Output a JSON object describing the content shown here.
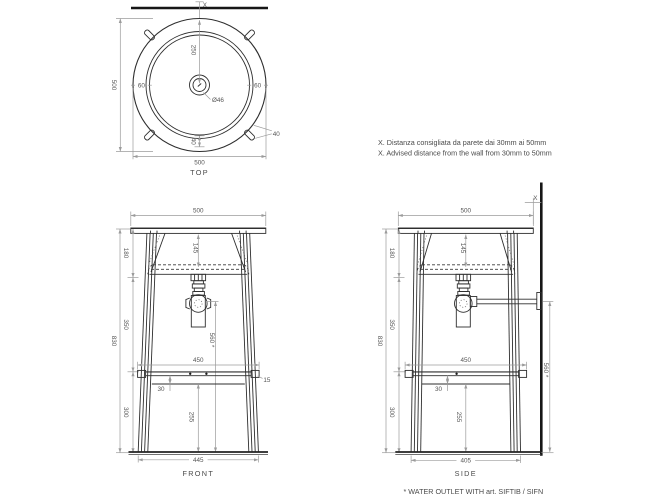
{
  "notes": {
    "line1_it": "X. Distanza consigliata da parete dai 30mm ai 50mm",
    "line2_en": "X. Advised distance from the wall from 30mm to 50mm"
  },
  "footnote": "* WATER OUTLET WITH art. SIFTIB / SIFN",
  "top_view": {
    "label": "TOP",
    "wall_offset": "X",
    "height_500": "500",
    "width_500": "500",
    "center_250": "250",
    "rim_60_left": "60",
    "rim_60_right": "60",
    "drain_dia": "Ø46",
    "rim_40": "40",
    "lug_40": "40"
  },
  "front_view": {
    "label": "FRONT",
    "width_500": "500",
    "basin_145": "145",
    "seg_180": "180",
    "seg_350": "350",
    "total_830": "830",
    "seg_300": "300",
    "outlet_560": "560 *",
    "shelf_450": "450",
    "overhang_15": "15",
    "rail_30": "30",
    "clear_255": "255",
    "base_445": "445"
  },
  "side_view": {
    "label": "SIDE",
    "width_500": "500",
    "wall_offset": "X",
    "basin_145": "145",
    "seg_180": "180",
    "seg_350": "350",
    "total_830": "830",
    "seg_300": "300",
    "outlet_560": "560 *",
    "shelf_450": "450",
    "rail_30": "30",
    "clear_255": "255",
    "base_405": "405"
  }
}
